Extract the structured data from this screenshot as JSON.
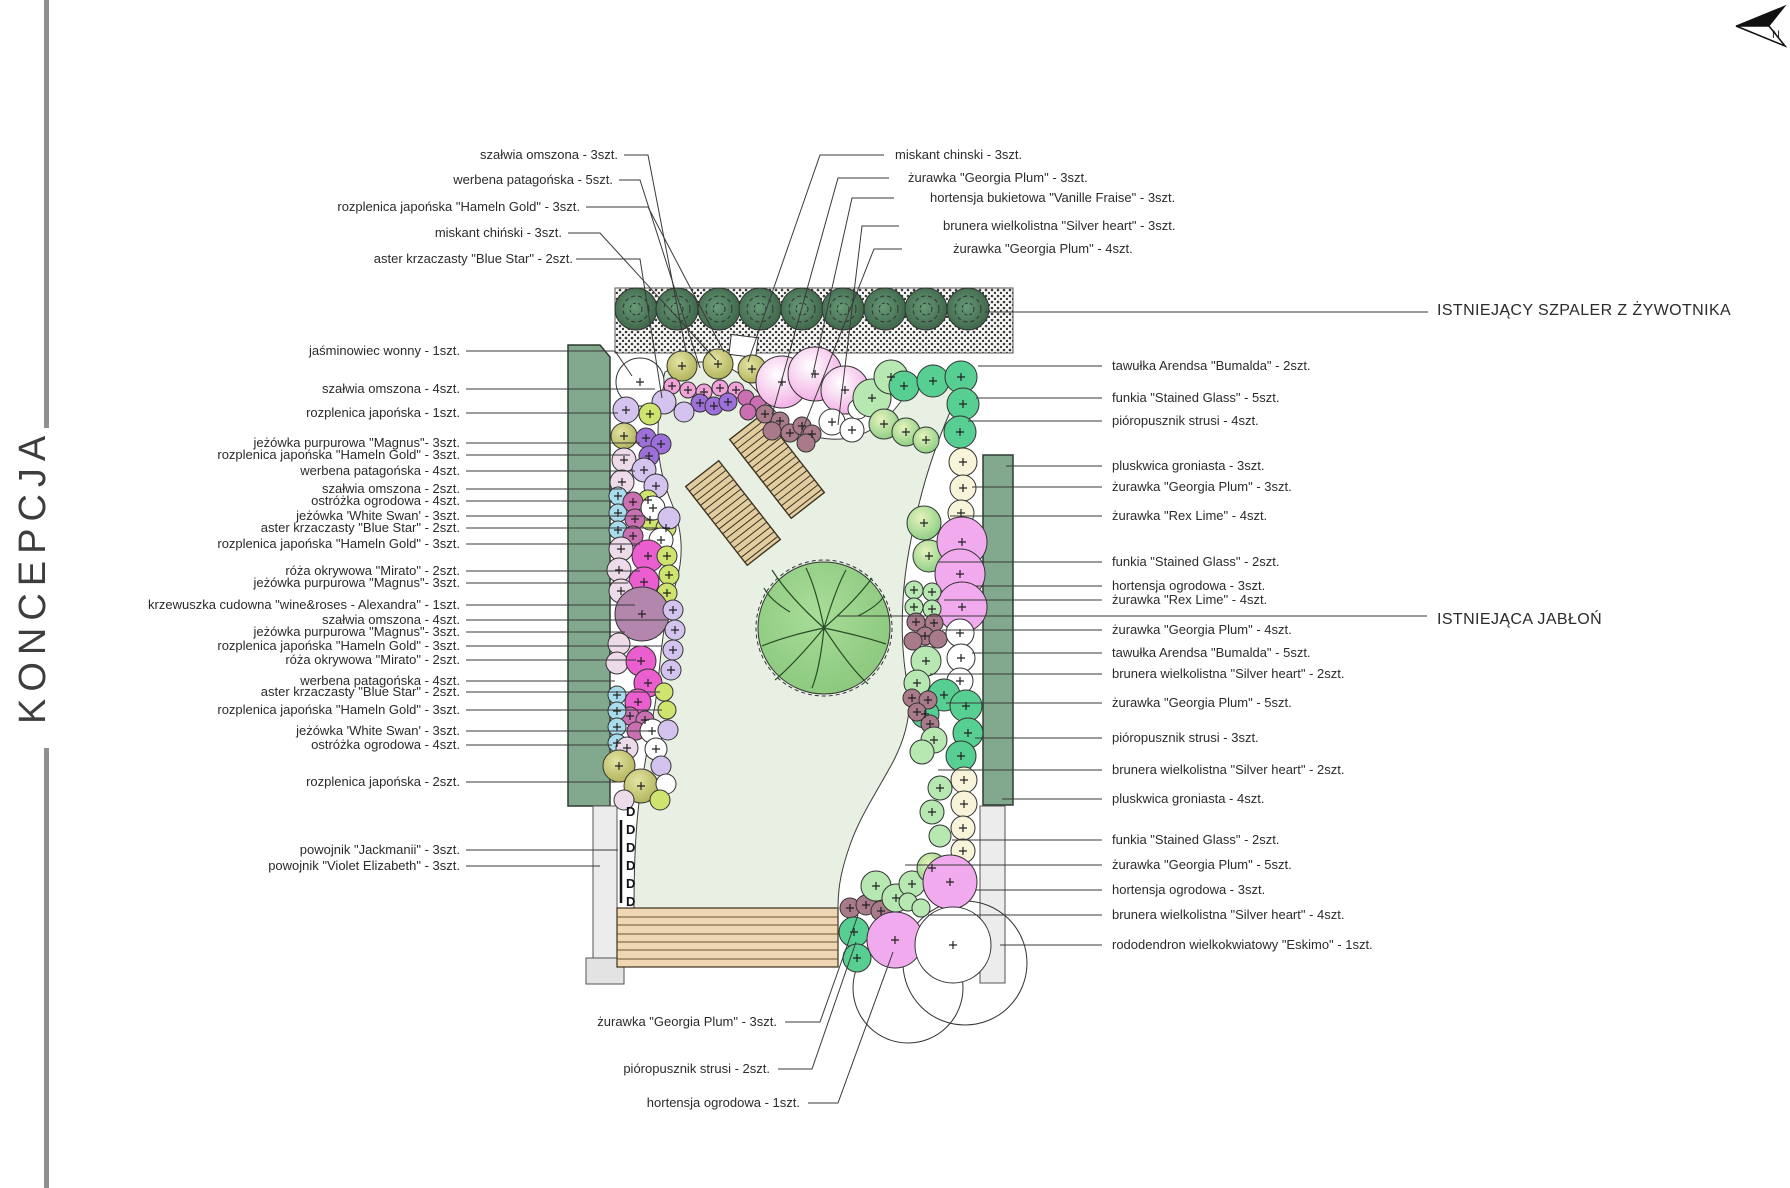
{
  "title": "KONCEPCJA",
  "north_label": "N",
  "captions": {
    "szpaler": "ISTNIEJĄCY SZPALER Z ŻYWOTNIKA",
    "jablon": "ISTNIEJĄCA JABŁOŃ"
  },
  "labels_top_left": [
    "szałwia omszona - 3szt.",
    "werbena patagońska - 5szt.",
    "rozplenica japońska \"Hameln Gold\" - 3szt.",
    "miskant chiński - 3szt.",
    "aster krzaczasty \"Blue Star\" - 2szt."
  ],
  "labels_top_right": [
    "miskant chinski - 3szt.",
    "żurawka \"Georgia Plum\" - 3szt.",
    "hortensja bukietowa \"Vanille Fraise\" - 3szt.",
    "brunera wielkolistna \"Silver heart\" - 3szt.",
    "żurawka \"Georgia Plum\" - 4szt."
  ],
  "labels_left": [
    "jaśminowiec wonny - 1szt.",
    "szałwia omszona - 4szt.",
    "rozplenica japońska - 1szt.",
    "jeżówka purpurowa \"Magnus\"- 3szt.",
    "rozplenica japońska \"Hameln Gold\" - 3szt.",
    "werbena patagońska - 4szt.",
    "szałwia omszona - 2szt.",
    "ostróżka ogrodowa - 4szt.",
    "jeżówka 'White Swan'  - 3szt.",
    "aster krzaczasty \"Blue Star\" - 2szt.",
    "rozplenica japońska \"Hameln Gold\" - 3szt.",
    "róża okrywowa \"Mirato\" - 2szt.",
    "jeżówka purpurowa \"Magnus\"- 3szt.",
    "krzewuszka cudowna \"wine&roses - Alexandra\" - 1szt.",
    "szałwia omszona - 4szt.",
    "jeżówka purpurowa \"Magnus\"- 3szt.",
    "rozplenica japońska \"Hameln Gold\" - 3szt.",
    "róża okrywowa \"Mirato\" - 2szt.",
    "werbena patagońska - 4szt.",
    "aster krzaczasty \"Blue Star\" - 2szt.",
    "rozplenica japońska \"Hameln Gold\" - 3szt.",
    "jeżówka 'White Swan'  - 3szt.",
    "ostróżka ogrodowa - 4szt.",
    "rozplenica japońska - 2szt.",
    "powojnik \"Jackmanii\" - 3szt.",
    "powojnik \"Violet Elizabeth\" - 3szt."
  ],
  "labels_right": [
    "tawułka Arendsa \"Bumalda\" - 2szt.",
    "funkia \"Stained Glass\" - 5szt.",
    "pióropusznik strusi - 4szt.",
    "pluskwica groniasta - 3szt.",
    "żurawka \"Georgia Plum\"  - 3szt.",
    "żurawka \"Rex Lime\"  - 4szt.",
    "funkia \"Stained Glass\" - 2szt.",
    "hortensja ogrodowa - 3szt.",
    "żurawka \"Rex Lime\"  - 4szt.",
    "żurawka \"Georgia Plum\"  - 4szt.",
    "tawułka Arendsa \"Bumalda\" - 5szt.",
    "brunera wielkolistna \"Silver heart\" - 2szt.",
    "żurawka \"Georgia Plum\"  - 5szt.",
    "pióropusznik strusi - 3szt.",
    "brunera wielkolistna \"Silver heart\" - 2szt.",
    "pluskwica groniasta - 4szt.",
    "funkia \"Stained Glass\" - 2szt.",
    "żurawka \"Georgia Plum\" - 5szt.",
    "hortensja ogrodowa - 3szt.",
    "brunera wielkolistna \"Silver heart\" - 4szt.",
    "rododendron wielkokwiatowy \"Eskimo\" - 1szt."
  ],
  "labels_bottom": [
    "żurawka \"Georgia Plum\" - 3szt.",
    "pióropusznik strusi - 2szt.",
    "hortensja ogrodowa - 1szt."
  ],
  "colors": {
    "hedge_bed": "#82a98e",
    "thuja_dark": "#35593f",
    "lawn": "#e7f0e2",
    "deck": "#eed7b2",
    "tree": "#94d189",
    "wall": "#ececec",
    "bright_pink": "#ea5ecf",
    "orchid": "#f2aaef",
    "emerald": "#57ce92",
    "lavender": "#d4c3ef",
    "violet": "#9d6fd8",
    "light_blue": "#a9dced",
    "rose_brown": "#a87a8a",
    "mauve": "#b286ad",
    "yellow_green": "#cfe36f"
  }
}
